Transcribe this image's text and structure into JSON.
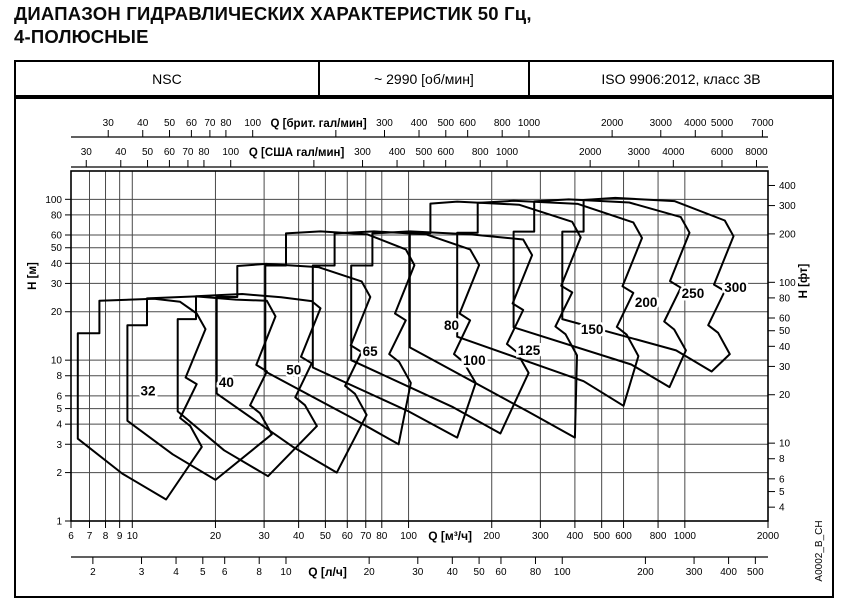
{
  "title": {
    "line1": "ДИАПАЗОН ГИДРАВЛИЧЕСКИХ ХАРАКТЕРИСТИК 50 Гц,",
    "line2": "4-ПОЛЮСНЫЕ"
  },
  "header": {
    "series": "NSC",
    "speed": "~ 2990 [об/мин]",
    "standard": "ISO 9906:2012, класс 3В"
  },
  "chart_data": {
    "type": "area",
    "description": "Hydraulic coverage chart, log-log scales, pump size envelopes",
    "grid": true,
    "q_range_m3h": [
      6,
      2000
    ],
    "h_range_m": [
      1,
      150
    ],
    "x_axes": [
      {
        "id": "uk_gpm",
        "label": "Q [брит. гал/мин]",
        "unit_to_m3h": 0.27276,
        "label_after": 100,
        "ticks": [
          30,
          40,
          50,
          60,
          70,
          80,
          100,
          300,
          400,
          500,
          600,
          800,
          1000,
          2000,
          3000,
          4000,
          5000,
          7000
        ],
        "extra_ticks": [
          200
        ]
      },
      {
        "id": "us_gpm",
        "label": "Q [США гал/мин]",
        "unit_to_m3h": 0.22712,
        "label_after": 100,
        "ticks": [
          30,
          40,
          50,
          60,
          70,
          80,
          100,
          300,
          400,
          500,
          600,
          800,
          1000,
          2000,
          3000,
          4000,
          6000,
          8000
        ],
        "extra_ticks": [
          200
        ]
      },
      {
        "id": "m3h",
        "label": "Q [м³/ч]",
        "unit_to_m3h": 1,
        "label_after": 100,
        "ticks": [
          6,
          7,
          8,
          9,
          10,
          20,
          30,
          40,
          50,
          60,
          70,
          80,
          100,
          200,
          300,
          400,
          500,
          600,
          800,
          1000,
          2000
        ],
        "extra_ticks": []
      },
      {
        "id": "ls",
        "label": "Q [л/ч]",
        "unit_to_m3h": 3.6,
        "label_after": 10,
        "ticks": [
          2,
          3,
          4,
          5,
          6,
          8,
          10,
          20,
          30,
          40,
          50,
          60,
          80,
          100,
          200,
          300,
          400,
          500
        ],
        "extra_ticks": []
      }
    ],
    "y_axes": [
      {
        "id": "m",
        "label": "H [м]",
        "unit_to_m": 1,
        "ticks": [
          1,
          2,
          3,
          4,
          5,
          6,
          8,
          10,
          20,
          30,
          40,
          50,
          60,
          80,
          100
        ]
      },
      {
        "id": "ft",
        "label": "H [фт]",
        "unit_to_m": 0.3048,
        "ticks": [
          4,
          5,
          6,
          8,
          10,
          20,
          30,
          40,
          50,
          60,
          80,
          100,
          200,
          300,
          400
        ]
      }
    ],
    "regions": [
      {
        "label": "32",
        "label_at": [
          11.4,
          6.4
        ],
        "points": [
          [
            6.35,
            3.25
          ],
          [
            6.35,
            14.7
          ],
          [
            7.6,
            14.7
          ],
          [
            7.6,
            23.4
          ],
          [
            12,
            24.1
          ],
          [
            14.9,
            23.05
          ],
          [
            17.1,
            19.5
          ],
          [
            18.4,
            15.6
          ],
          [
            15.6,
            7.8
          ],
          [
            17.1,
            7.1
          ],
          [
            14.9,
            4.37
          ],
          [
            16.2,
            3.9
          ],
          [
            17.85,
            2.89
          ],
          [
            13.25,
            1.36
          ],
          [
            9.2,
            1.97
          ]
        ]
      },
      {
        "label": "40",
        "label_at": [
          21.9,
          7.2
        ],
        "points": [
          [
            9.6,
            4.2
          ],
          [
            9.6,
            16.5
          ],
          [
            11.3,
            16.5
          ],
          [
            11.3,
            24.2
          ],
          [
            17,
            24.9
          ],
          [
            23.7,
            23.8
          ],
          [
            30.7,
            23.4
          ],
          [
            33,
            18.7
          ],
          [
            28.1,
            9.35
          ],
          [
            30.7,
            8.51
          ],
          [
            26.7,
            5.24
          ],
          [
            29,
            4.68
          ],
          [
            32,
            3.46
          ],
          [
            20,
            1.8
          ],
          [
            14,
            2.6
          ]
        ]
      },
      {
        "label": "50",
        "label_at": [
          38.4,
          8.65
        ],
        "points": [
          [
            14.6,
            4.8
          ],
          [
            14.6,
            18
          ],
          [
            17,
            18
          ],
          [
            17,
            25
          ],
          [
            25,
            25.8
          ],
          [
            34.6,
            24.6
          ],
          [
            44.6,
            23.3
          ],
          [
            48,
            21
          ],
          [
            40.8,
            10.5
          ],
          [
            44.6,
            9.56
          ],
          [
            38.9,
            5.88
          ],
          [
            42.2,
            5.25
          ],
          [
            46.6,
            3.89
          ],
          [
            31,
            1.9
          ],
          [
            21.5,
            2.75
          ]
        ]
      },
      {
        "label": "65",
        "label_at": [
          72.6,
          11.2
        ],
        "points": [
          [
            20.2,
            6.2
          ],
          [
            20.2,
            24.7
          ],
          [
            24,
            24.7
          ],
          [
            24,
            38.5
          ],
          [
            30.5,
            39.7
          ],
          [
            47.1,
            37.9
          ],
          [
            67.6,
            30.9
          ],
          [
            72.7,
            24.7
          ],
          [
            61.8,
            12.35
          ],
          [
            67.6,
            11.24
          ],
          [
            58.9,
            6.92
          ],
          [
            64,
            6.18
          ],
          [
            70.5,
            4.57
          ],
          [
            55,
            2.0
          ],
          [
            38,
            2.9
          ]
        ]
      },
      {
        "label": "80",
        "label_at": [
          143,
          16.3
        ],
        "points": [
          [
            30.3,
            8.5
          ],
          [
            30.3,
            38.8
          ],
          [
            36,
            38.8
          ],
          [
            36,
            61.4
          ],
          [
            48,
            63.2
          ],
          [
            71,
            60.5
          ],
          [
            97.7,
            48.8
          ],
          [
            105,
            39
          ],
          [
            89.3,
            19.5
          ],
          [
            97.7,
            17.7
          ],
          [
            85.1,
            10.9
          ],
          [
            92.4,
            9.75
          ],
          [
            101.9,
            7.22
          ],
          [
            92,
            3.0
          ],
          [
            62,
            4.4
          ]
        ]
      },
      {
        "label": "100",
        "label_at": [
          173,
          9.9
        ],
        "points": [
          [
            45,
            9
          ],
          [
            45,
            38.8
          ],
          [
            54,
            38.8
          ],
          [
            54,
            61.4
          ],
          [
            75,
            63.2
          ],
          [
            116,
            60.5
          ],
          [
            167,
            48.8
          ],
          [
            180,
            39
          ],
          [
            153,
            19.5
          ],
          [
            167,
            17.7
          ],
          [
            146,
            10.9
          ],
          [
            158,
            9.75
          ],
          [
            175,
            7.22
          ],
          [
            150,
            3.3
          ],
          [
            100,
            4.8
          ]
        ]
      },
      {
        "label": "125",
        "label_at": [
          273,
          11.4
        ],
        "points": [
          [
            62,
            10
          ],
          [
            62,
            38.8
          ],
          [
            74,
            38.8
          ],
          [
            74,
            61.4
          ],
          [
            101,
            63.2
          ],
          [
            168,
            60.5
          ],
          [
            260,
            56.3
          ],
          [
            280,
            45
          ],
          [
            238,
            22.5
          ],
          [
            260,
            20.5
          ],
          [
            227,
            12.6
          ],
          [
            246,
            11.25
          ],
          [
            272,
            8.33
          ],
          [
            215,
            3.5
          ],
          [
            145,
            5.1
          ]
        ]
      },
      {
        "label": "150",
        "label_at": [
          462,
          15.4
        ],
        "points": [
          [
            101,
            12
          ],
          [
            101,
            61.4
          ],
          [
            120,
            61.4
          ],
          [
            120,
            94
          ],
          [
            150,
            96.8
          ],
          [
            251,
            92.6
          ],
          [
            391,
            72.5
          ],
          [
            420,
            58
          ],
          [
            357,
            29
          ],
          [
            391,
            26.4
          ],
          [
            340,
            16.2
          ],
          [
            370,
            14.5
          ],
          [
            407,
            10.7
          ],
          [
            400,
            3.3
          ],
          [
            270,
            4.8
          ]
        ]
      },
      {
        "label": "200",
        "label_at": [
          724,
          22.6
        ],
        "points": [
          [
            150,
            14
          ],
          [
            150,
            62
          ],
          [
            178,
            62
          ],
          [
            178,
            95
          ],
          [
            240,
            97.9
          ],
          [
            410,
            93.6
          ],
          [
            651,
            71.9
          ],
          [
            700,
            57.5
          ],
          [
            595,
            28.8
          ],
          [
            651,
            26.2
          ],
          [
            567,
            16.1
          ],
          [
            616,
            14.4
          ],
          [
            679,
            10.6
          ],
          [
            600,
            5.2
          ],
          [
            430,
            7.4
          ]
        ]
      },
      {
        "label": "250",
        "label_at": [
          1070,
          25.8
        ],
        "points": [
          [
            240,
            16
          ],
          [
            240,
            63
          ],
          [
            285,
            63
          ],
          [
            285,
            97
          ],
          [
            380,
            99.9
          ],
          [
            629,
            95.5
          ],
          [
            967,
            77.5
          ],
          [
            1040,
            62
          ],
          [
            884,
            31
          ],
          [
            967,
            28.2
          ],
          [
            842,
            17.4
          ],
          [
            915,
            15.5
          ],
          [
            1009,
            11.5
          ],
          [
            880,
            6.8
          ],
          [
            640,
            9.4
          ]
        ]
      },
      {
        "label": "300",
        "label_at": [
          1525,
          28.1
        ],
        "points": [
          [
            360,
            18
          ],
          [
            360,
            63
          ],
          [
            430,
            63
          ],
          [
            430,
            99
          ],
          [
            560,
            102
          ],
          [
            917,
            97.5
          ],
          [
            1395,
            73.8
          ],
          [
            1500,
            59
          ],
          [
            1275,
            29.5
          ],
          [
            1395,
            26.9
          ],
          [
            1215,
            16.5
          ],
          [
            1320,
            14.8
          ],
          [
            1455,
            10.9
          ],
          [
            1250,
            8.5
          ],
          [
            930,
            11.5
          ]
        ]
      }
    ],
    "watermark": "A0002_B_CH",
    "colors": {
      "line": "#000000",
      "grid": "#4a4a4a",
      "text": "#000000",
      "background": "#ffffff"
    }
  }
}
